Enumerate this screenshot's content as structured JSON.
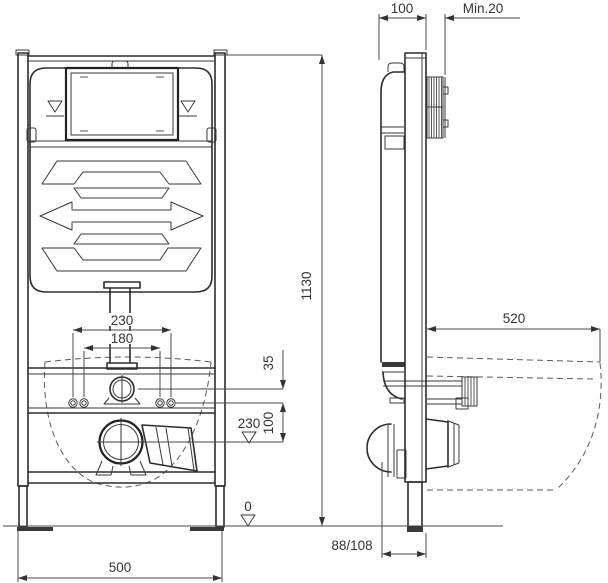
{
  "drawing": {
    "front_view": {
      "width_label": "500",
      "height_label": "1130",
      "outer_bolt_spacing": "230",
      "inner_bolt_spacing": "180",
      "supply_offset": "35",
      "supply_to_drain": "100",
      "drain_height_datum": "230",
      "floor_datum": "0"
    },
    "side_view": {
      "frame_depth": "100",
      "min_wall_clearance": "Min.20",
      "bowl_depth": "520",
      "drain_wall_distance": "88/108"
    }
  }
}
